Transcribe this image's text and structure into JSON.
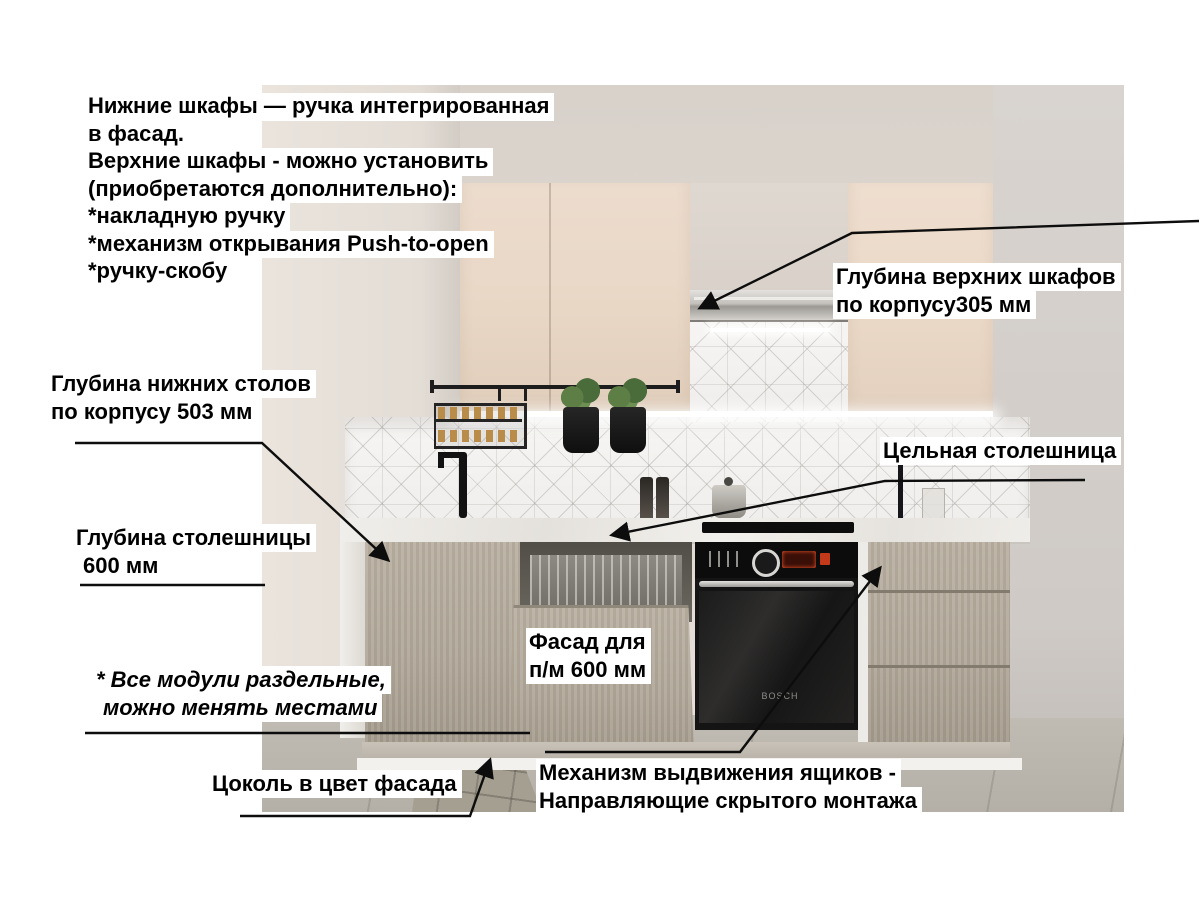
{
  "annotations": {
    "top_note": {
      "lines": [
        "Нижние шкафы — ручка интегрированная",
        "в фасад.",
        "Верхние шкафы - можно установить",
        "(приобретаются дополнительно):",
        "*накладную ручку",
        "*механизм открывания Push-to-open",
        "*ручку-скобу"
      ]
    },
    "upper_cabinet_depth": {
      "lines": [
        "Глубина верхних шкафов",
        "по корпусу305 мм"
      ]
    },
    "base_cabinet_depth": {
      "lines": [
        "Глубина нижних столов",
        "по корпусу 503 мм"
      ]
    },
    "countertop_depth": {
      "lines": [
        "Глубина столешницы",
        "600 мм"
      ]
    },
    "solid_countertop": {
      "label": "Цельная столешница"
    },
    "dishwasher_front": {
      "lines": [
        "Фасад для",
        "п/м 600 мм"
      ]
    },
    "modules_note": {
      "lines": [
        "* Все модули раздельные,",
        "можно менять местами"
      ]
    },
    "plinth": {
      "label": "Цоколь в цвет фасада"
    },
    "drawer_mechanism": {
      "lines": [
        "Механизм выдвижения ящиков -",
        "Направляющие скрытого монтажа"
      ]
    }
  },
  "scene": {
    "oven_brand": "BOSCH"
  },
  "colors": {
    "page_bg": "#ffffff",
    "annotation_text": "#000000",
    "annotation_bg": "#ffffff",
    "leader_line": "#0d0d0d",
    "upper_cabinet": "#ecdccd",
    "base_cabinet": "#b0a799",
    "countertop": "#efede9",
    "oven_display": "#c23a1a"
  }
}
